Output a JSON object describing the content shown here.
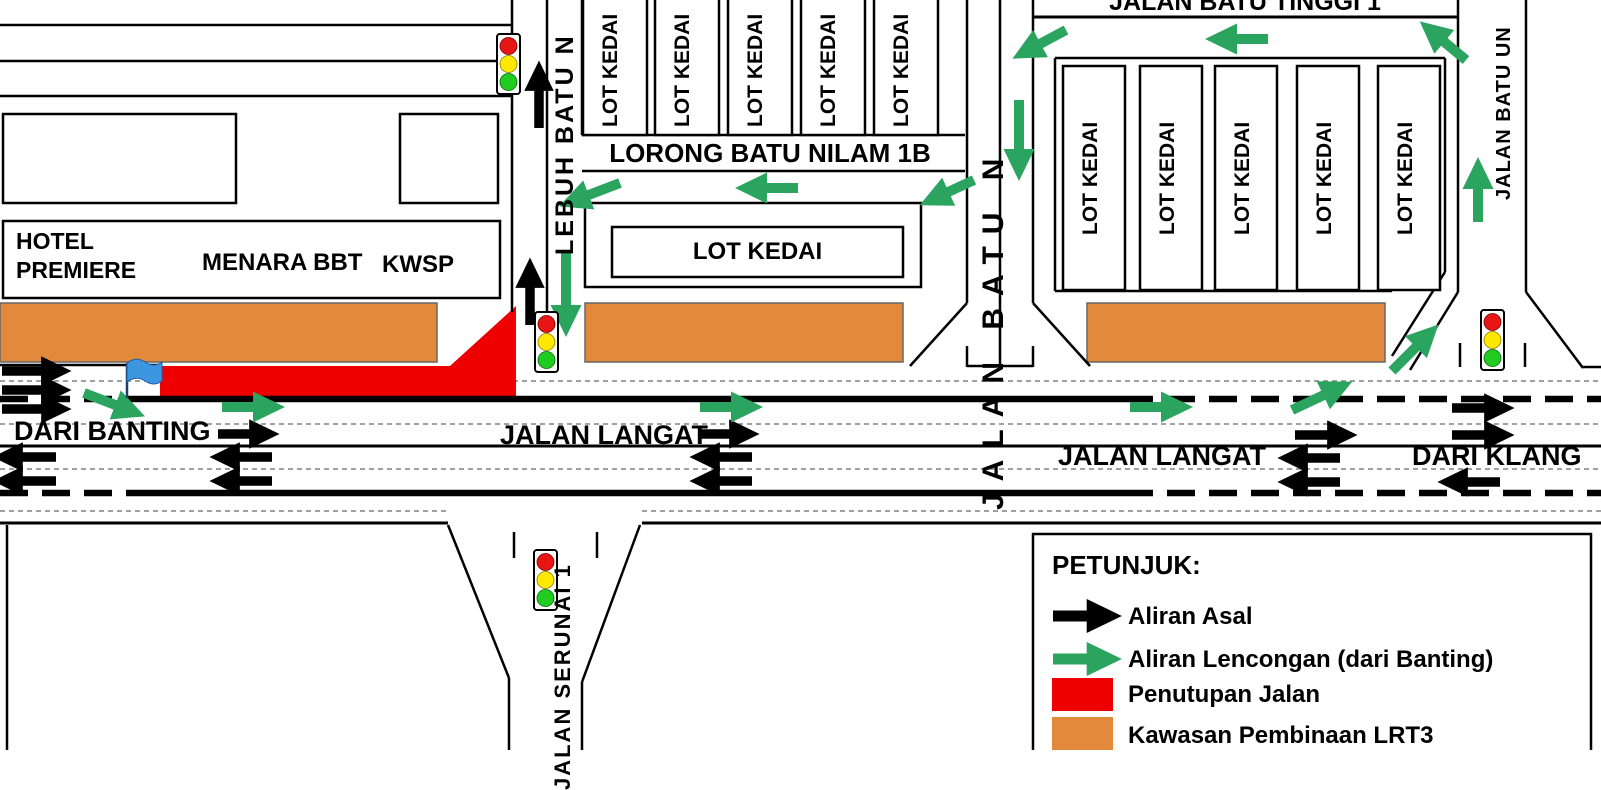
{
  "map": {
    "title_context": "LRT3 road diversion plan",
    "roads": {
      "dari_banting": "DARI BANTING",
      "jalan_langat_west": "JALAN LANGAT",
      "jalan_langat_east": "JALAN LANGAT",
      "dari_klang": "DARI KLANG",
      "lorong_batu_nilam_1b": "LORONG BATU NILAM 1B",
      "jalan_batu_tinggi_1": "JALAN BATU TINGGI 1",
      "lebuh_batu_n": "LEBUH BATU N",
      "jalan_batu_n": "JALAN BATU N",
      "jalan_batu_un": "JALAN BATU UN",
      "jalan_serunai_1": "JALAN SERUNAI 1"
    },
    "buildings": {
      "hotel_premiere": "HOTEL PREMIERE",
      "menara_bbt": "MENARA BBT",
      "kwsp": "KWSP",
      "lot_kedai_center": "LOT KEDAI",
      "left_row": [
        "LOT KEDAI",
        "LOT KEDAI",
        "LOT KEDAI",
        "LOT KEDAI",
        "LOT KEDAI"
      ],
      "right_row": [
        "LOT KEDAI",
        "LOT KEDAI",
        "LOT KEDAI",
        "LOT KEDAI",
        "LOT KEDAI"
      ]
    },
    "markers": {
      "traffic_light_count": 4,
      "flag_color": "#3c96e0"
    }
  },
  "legend": {
    "title": "PETUNJUK:",
    "items": [
      {
        "label": "Aliran Asal",
        "swatch": "black-arrow",
        "color": "#000000"
      },
      {
        "label": "Aliran Lencongan (dari Banting)",
        "swatch": "green-arrow",
        "color": "#2aa45f"
      },
      {
        "label": "Penutupan Jalan",
        "swatch": "red-box",
        "color": "#ee0000"
      },
      {
        "label": "Kawasan Pembinaan LRT3",
        "swatch": "orange-box",
        "color": "#e2893b"
      }
    ]
  },
  "colors": {
    "original_flow": "#000000",
    "diverted_flow": "#2aa45f",
    "road_closure": "#ee0000",
    "construction_zone": "#e2893b",
    "lane_dots": "#808080"
  }
}
